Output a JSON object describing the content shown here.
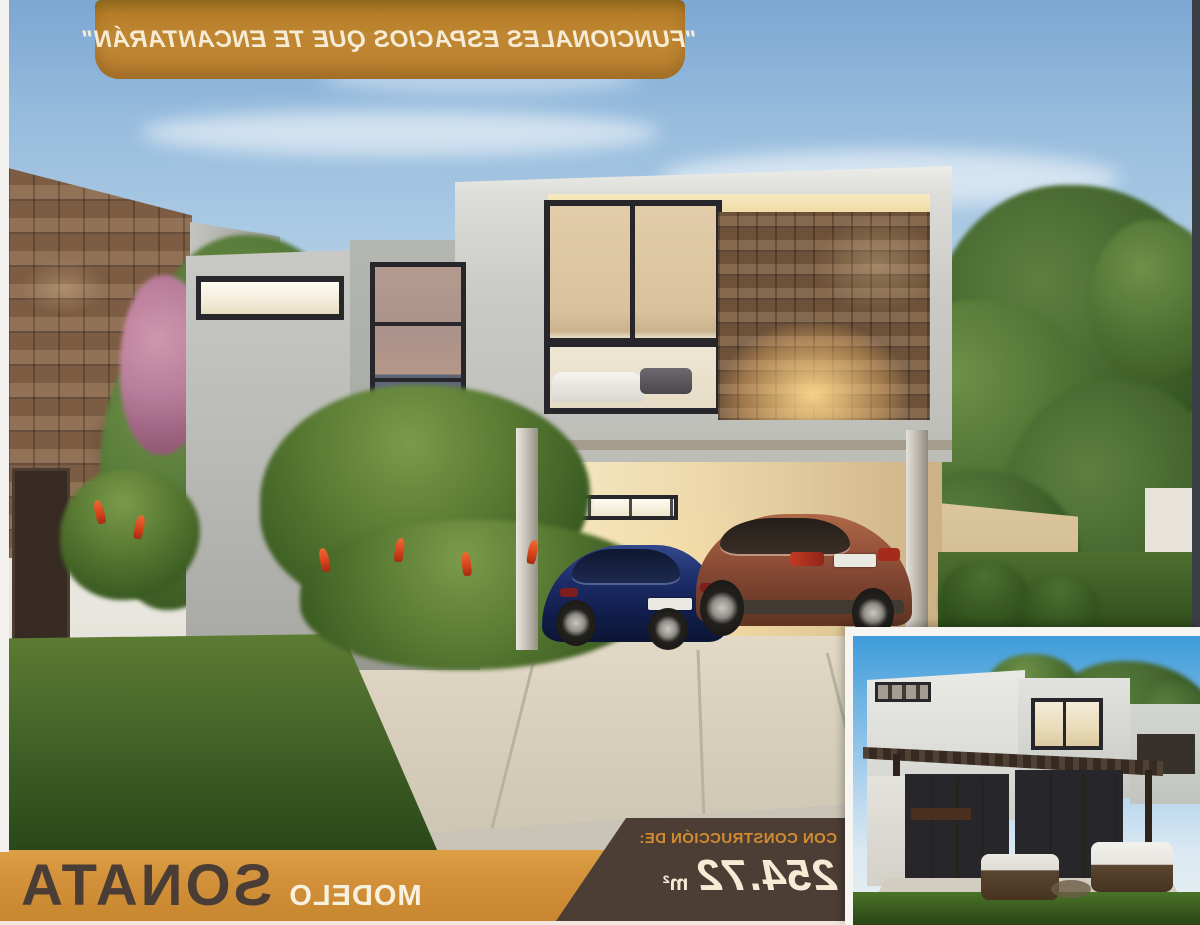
{
  "banner": {
    "quote": "\"FUNCIONALES ESPACIOS QUE TE ENCANTARÁN\""
  },
  "model_bar": {
    "label": "MODELO",
    "name": "SONATA"
  },
  "construction": {
    "label": "CON CONSTRUCCIÓN DE:",
    "area": "254.72",
    "unit": "m²"
  },
  "colors": {
    "banner_orange": "#c08733",
    "bar_orange": "#d2913a",
    "tag_brown": "#4c3d35",
    "title_brown": "#4a3d35",
    "cream": "#f6ecd6",
    "label_orange": "#d28c2f",
    "sky_blue": "#97bcdd",
    "grass_green": "#44662e"
  }
}
